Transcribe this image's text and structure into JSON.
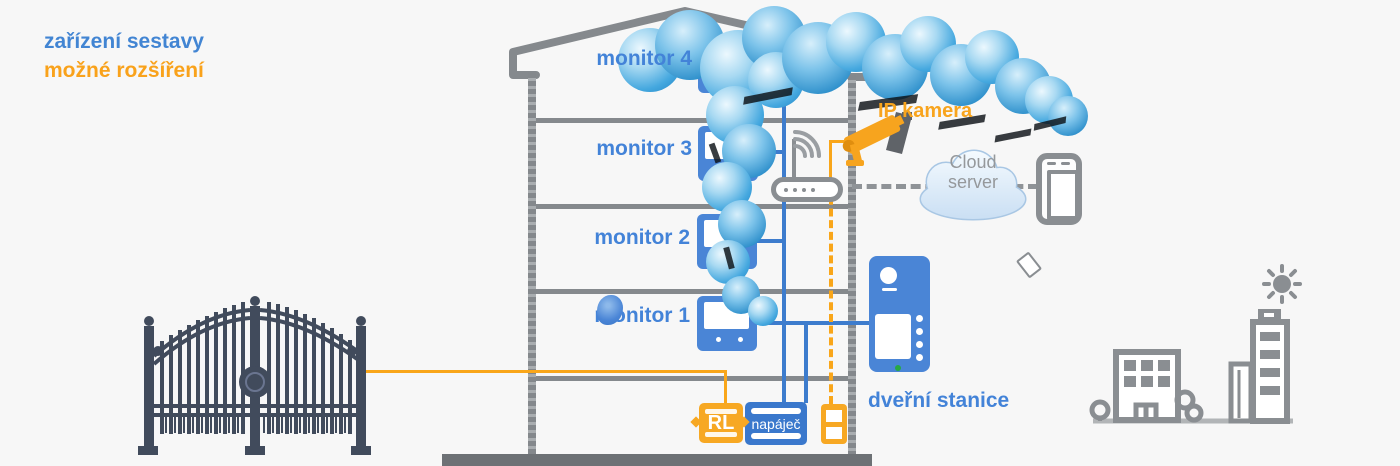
{
  "legend": {
    "system_devices": "zařízení sestavy",
    "possible_expansion": "možné rozšíření"
  },
  "devices": {
    "monitors": [
      {
        "label": "monitor 4"
      },
      {
        "label": "monitor 3"
      },
      {
        "label": "monitor 2"
      },
      {
        "label": "monitor 1"
      }
    ],
    "door_station": {
      "label": "dveřní stanice"
    },
    "ip_camera": {
      "label": "IP kamera"
    },
    "cloud_server": {
      "label_line1": "Cloud",
      "label_line2": "server"
    },
    "power_supply": {
      "label": "napáječ"
    },
    "relay": {
      "label": "RL"
    }
  },
  "colors": {
    "system_blue": "#4a85d6",
    "expansion_orange": "#f8a41d",
    "structure_gray": "#85898d",
    "background": "#f7f7f7"
  }
}
